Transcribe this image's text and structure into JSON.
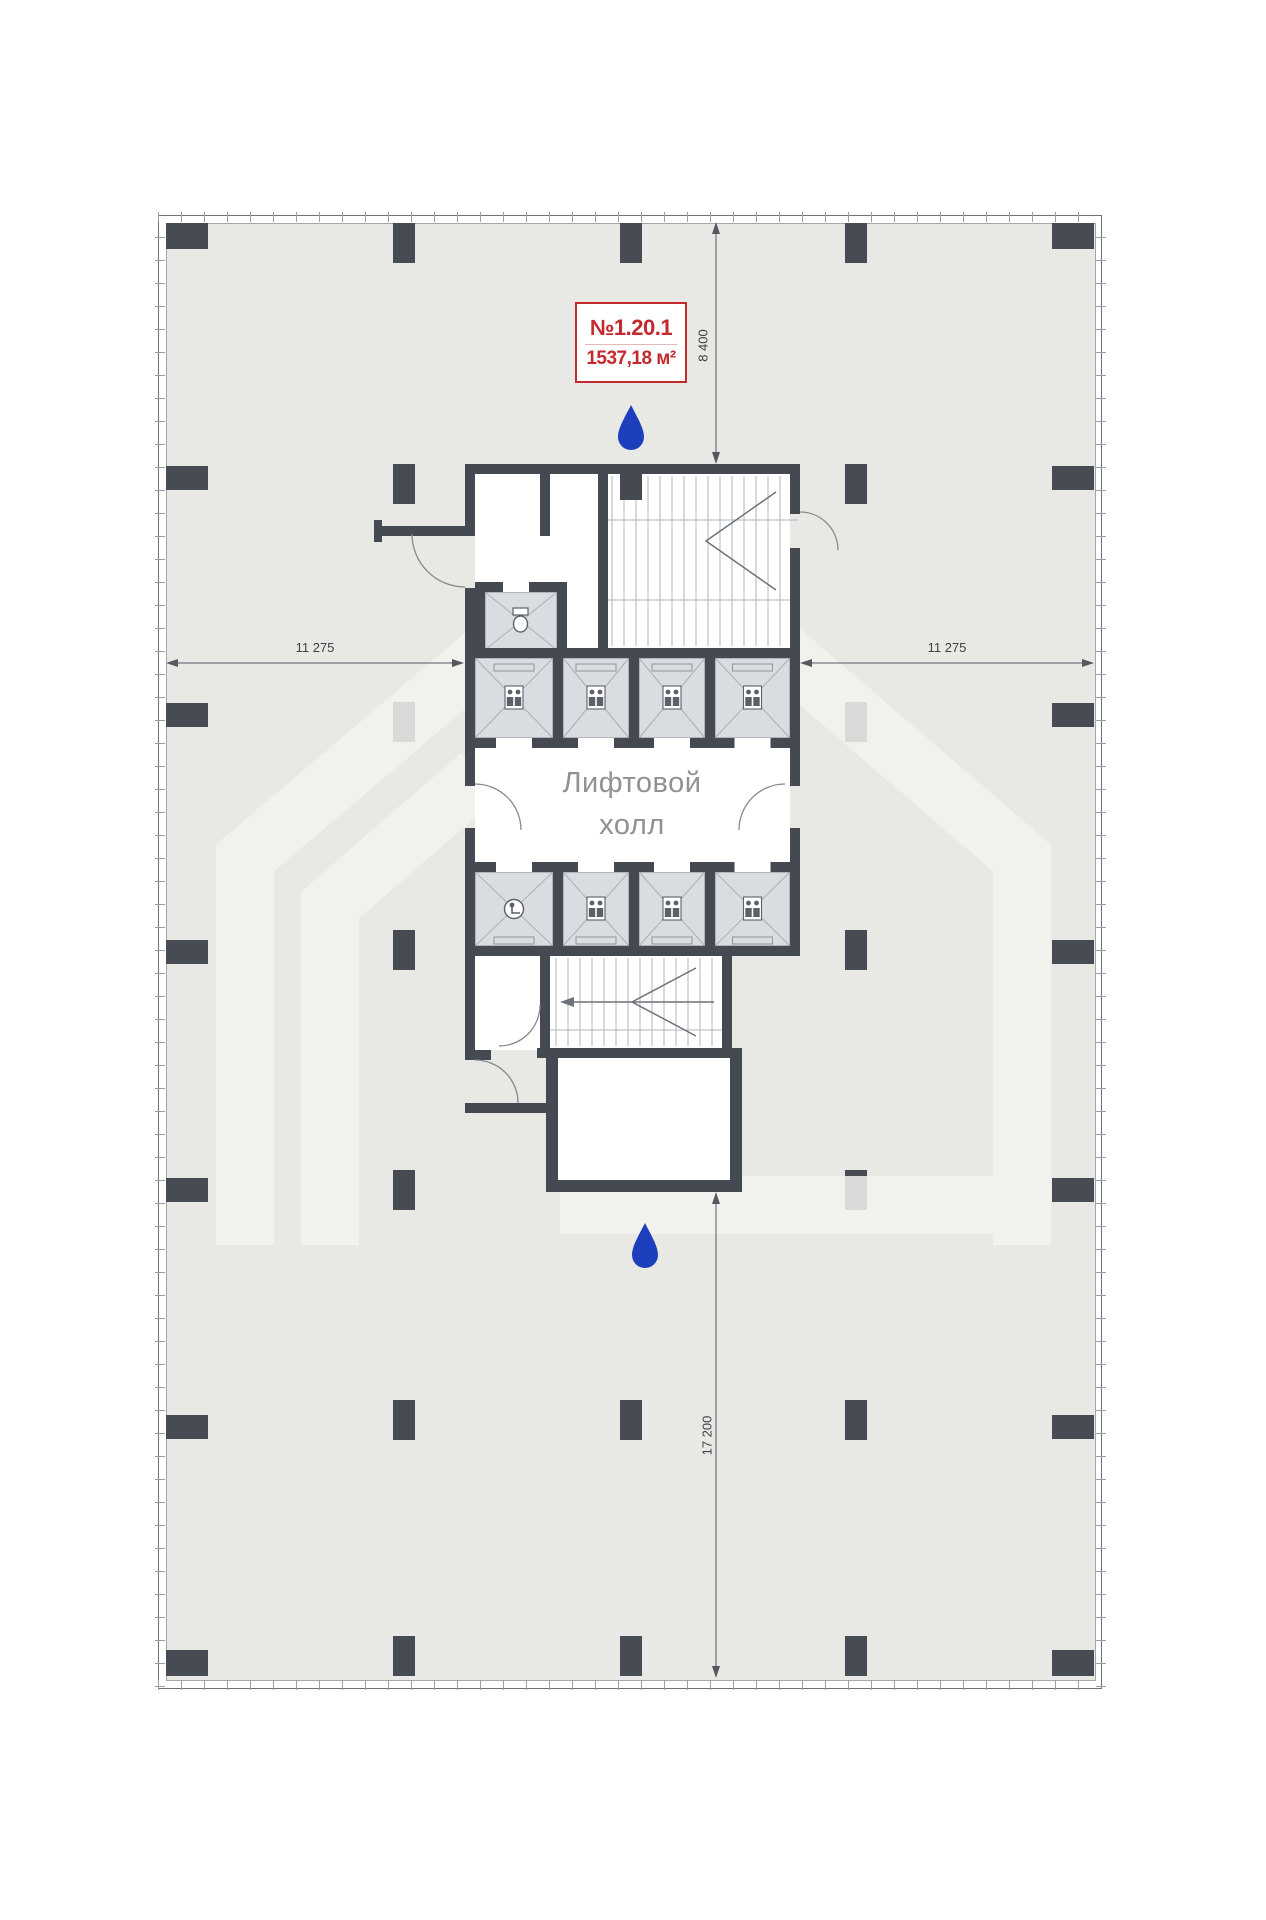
{
  "unit": {
    "number": "№1.20.1",
    "area": "1537,18 м²"
  },
  "lift_hall": {
    "line1": "Лифтовой",
    "line2": "холл"
  },
  "dimensions": {
    "top": "8 400",
    "bottom": "17 200",
    "left": "11 275",
    "right": "11 275"
  },
  "icons": {
    "water_drop": "water-drop",
    "people": "elevator-people",
    "wheelchair": "accessible-wc",
    "toilet": "toilet"
  },
  "colors": {
    "accent_red": "#c3292e",
    "drop_blue": "#1e3fbd",
    "wall_dark": "#454952",
    "floor_gray": "#e8e8e4",
    "shaft_gray": "#d9dce0"
  }
}
